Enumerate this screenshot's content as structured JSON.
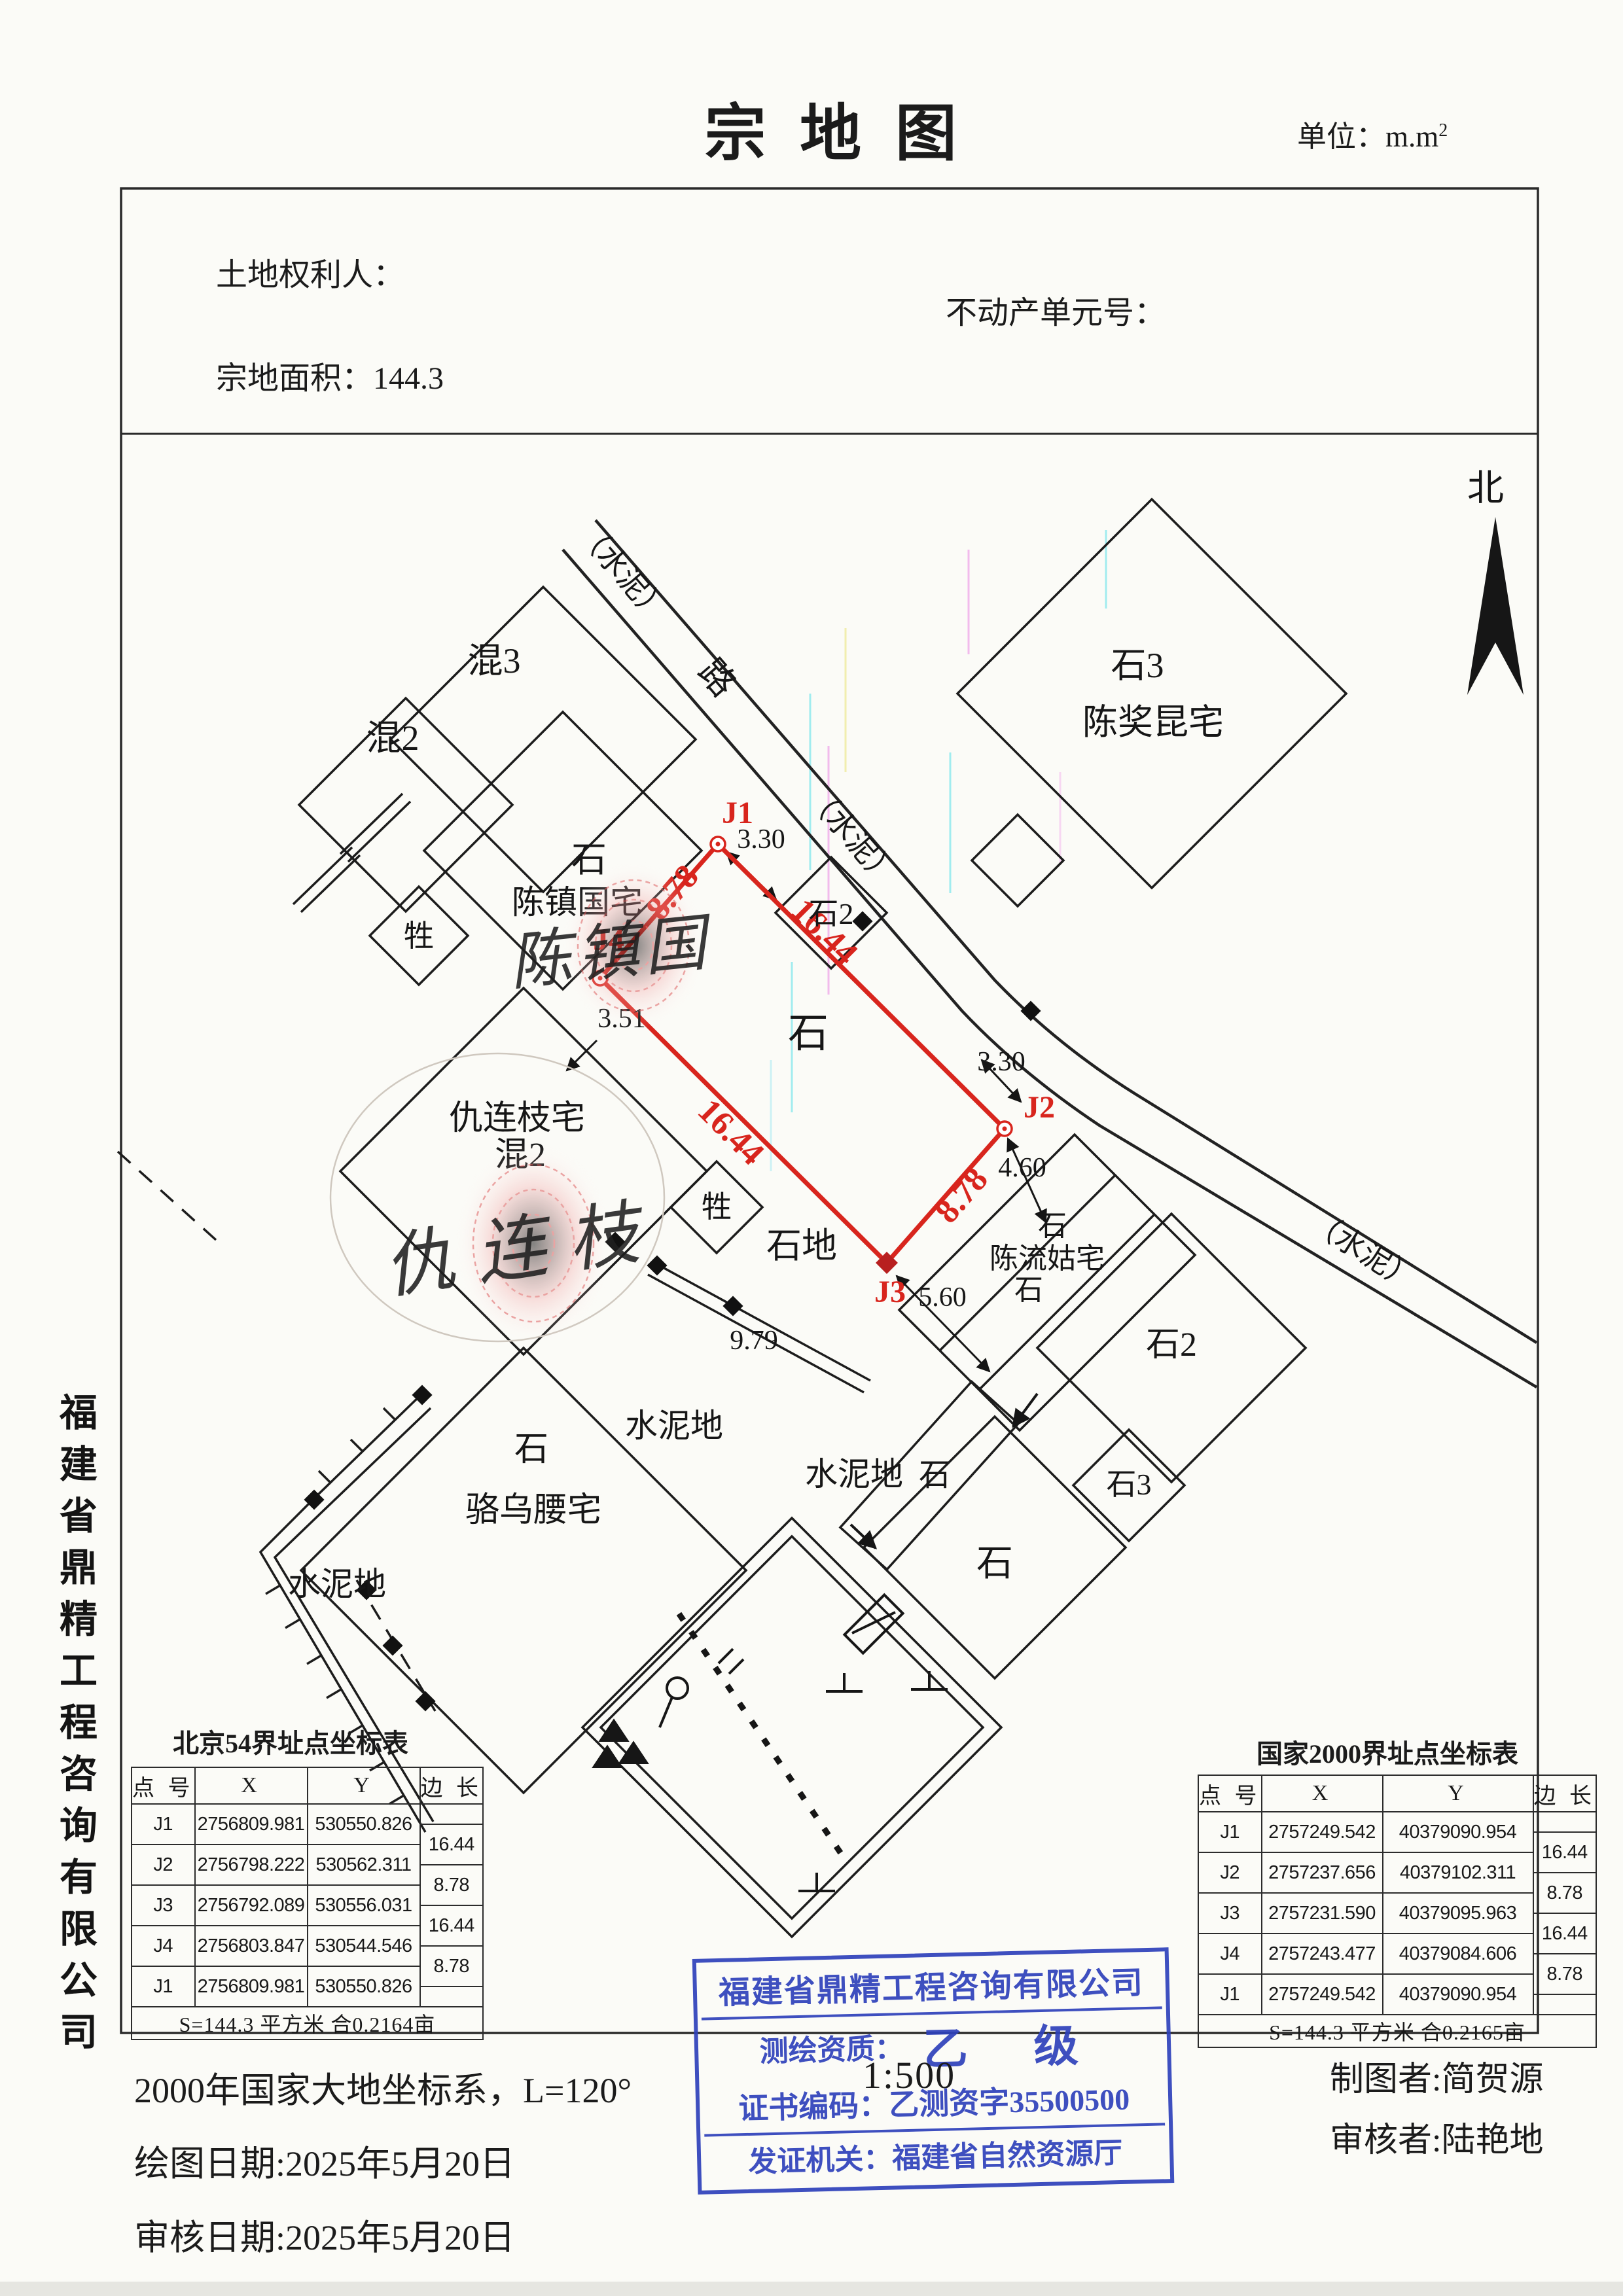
{
  "page": {
    "title": "宗地图",
    "unit_prefix": "单位：m.m",
    "unit_exponent": "2"
  },
  "header": {
    "owner": "土地权利人：",
    "estate_no": "不动产单元号：",
    "area": "宗地面积：144.3"
  },
  "compass": {
    "north": "北"
  },
  "company_sidebar": "福建省鼎精工程咨询有限公司",
  "map": {
    "roads": {
      "cement_top": "（水泥）",
      "road_char": "路",
      "cement_mid": "（水泥）",
      "cement_bottom": "（水泥）"
    },
    "parcel": {
      "corners": {
        "j1": "J1",
        "j2": "J2",
        "j3": "J3",
        "j4": "J4"
      },
      "edge_labels": {
        "j1j4": "8.78",
        "j1j2": "16.44",
        "j4j3": "16.44",
        "j2j3": "8.78"
      },
      "land_type": "石"
    },
    "dims": {
      "d330a": "3.30",
      "d330b": "3.30",
      "d351": "3.51",
      "d460": "4.60",
      "d560": "5.60",
      "d979": "9.79"
    },
    "labels": {
      "hun3": "混3",
      "hun2": "混2",
      "shi3_ne": "石3",
      "chen_jiang_kun": "陈奖昆宅",
      "shi_czg": "石",
      "chen_zhen_guo": "陈镇国宅",
      "sheng1": "牲",
      "sheng2": "牲",
      "qiu_lian_zhi": "仇连枝宅",
      "qiu_hun2": "混2",
      "shi2_road": "石2",
      "shi_di": "石地",
      "shi_clg_top": "石",
      "chen_liu_gu": "陈流姑宅",
      "shi_clg_bottom": "石",
      "shi2_se": "石2",
      "shi3_se": "石3",
      "shi_strip": "石",
      "shi_big": "石",
      "shi_lwy": "石",
      "luo_wu_yao": "骆乌腰宅",
      "shuinidi_left": "水泥地",
      "shuinidi_mid": "水泥地",
      "shuinidi_mid2": "水泥地"
    },
    "signatures": {
      "czg": "陈镇国",
      "qlz": "仇连枝"
    }
  },
  "tables": {
    "bj54": {
      "title": "北京54界址点坐标表",
      "headers": [
        "点 号",
        "X",
        "Y",
        "边 长"
      ],
      "rows": [
        [
          "J1",
          "2756809.981",
          "530550.826"
        ],
        [
          "J2",
          "2756798.222",
          "530562.311"
        ],
        [
          "J3",
          "2756792.089",
          "530556.031"
        ],
        [
          "J4",
          "2756803.847",
          "530544.546"
        ],
        [
          "J1",
          "2756809.981",
          "530550.826"
        ]
      ],
      "edges": [
        "16.44",
        "8.78",
        "16.44",
        "8.78"
      ],
      "footer": "S=144.3 平方米 合0.2164亩"
    },
    "cgcs2000": {
      "title": "国家2000界址点坐标表",
      "headers": [
        "点 号",
        "X",
        "Y",
        "边 长"
      ],
      "rows": [
        [
          "J1",
          "2757249.542",
          "40379090.954"
        ],
        [
          "J2",
          "2757237.656",
          "40379102.311"
        ],
        [
          "J3",
          "2757231.590",
          "40379095.963"
        ],
        [
          "J4",
          "2757243.477",
          "40379084.606"
        ],
        [
          "J1",
          "2757249.542",
          "40379090.954"
        ]
      ],
      "edges": [
        "16.44",
        "8.78",
        "16.44",
        "8.78"
      ],
      "footer": "S=144.3 平方米 合0.2165亩"
    }
  },
  "stamp": {
    "company": "福建省鼎精工程咨询有限公司",
    "qual_label": "测绘资质：",
    "qual_value": "乙 级",
    "cert_label": "证书编码：",
    "cert_value": "乙测资字35500500",
    "issuer_label": "发证机关：",
    "issuer_value": "福建省自然资源厅"
  },
  "footer": {
    "coord_system": "2000年国家大地坐标系，L=120°",
    "scale": "1:500",
    "draw_date": "绘图日期:2025年5月20日",
    "review_date": "审核日期:2025年5月20日",
    "cartographer": "制图者:简贺源",
    "reviewer": "审核者:陆艳地"
  },
  "colors": {
    "parcel_red": "#d8251d",
    "stamp_blue": "#2e41bb",
    "ink": "#1b1b1b"
  }
}
